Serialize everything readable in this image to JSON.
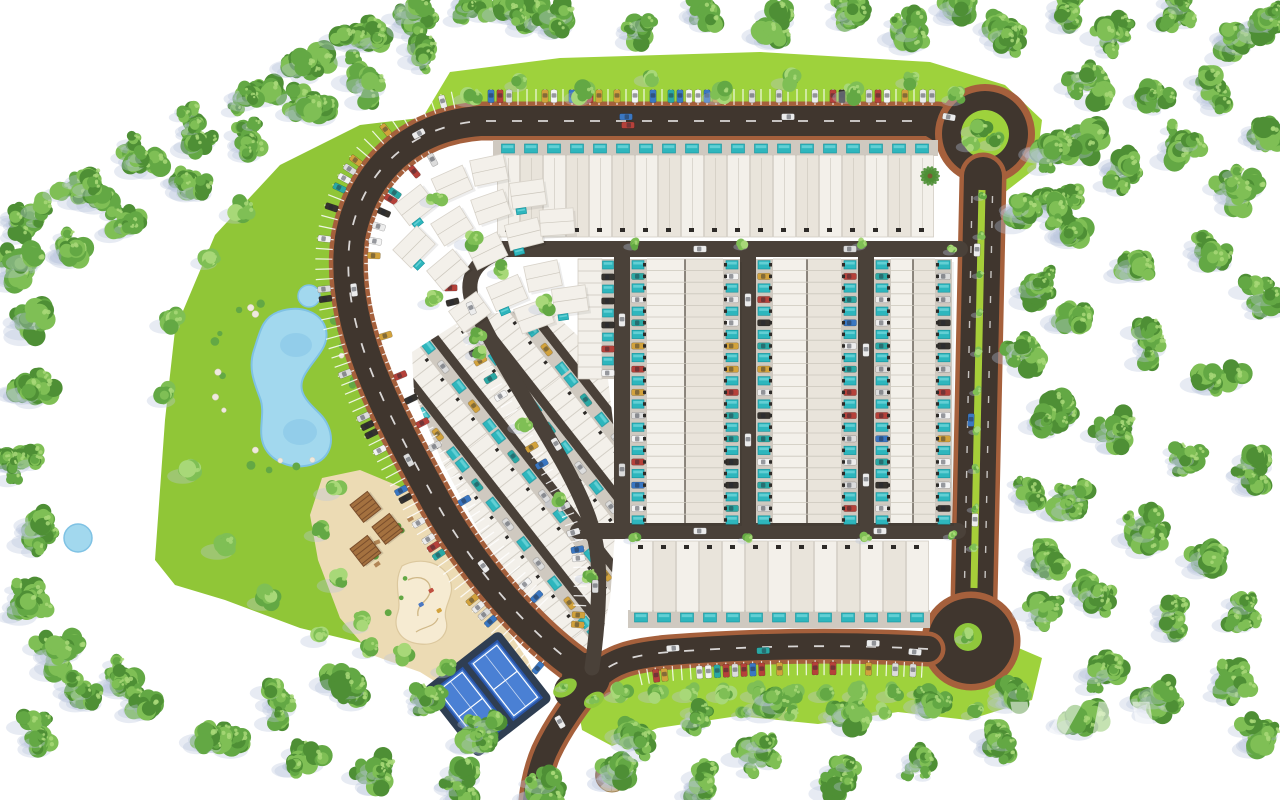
{
  "watermark": {
    "text": "VIV",
    "subtext": "E"
  },
  "scene": {
    "description": "Aerial top-down 3D masterplan rendering of a gated residential community: rows of white flat-roofed townhouses each with a private turquoise pool, a looping ring road with angled parking, a tree-lined boulevard with green median, two roundabouts, a landscaped park with a lake, a sand plaza with playground and pergolas, two blue padel courts, all surrounded by a dense green tree belt on white"
  },
  "features": [
    "perimeter-forest",
    "landscaped-park",
    "lake",
    "small-pond",
    "row-houses-with-private-pools",
    "villa-cluster",
    "ring-road",
    "large-roundabout",
    "cul-de-sac-roundabout",
    "boulevard-green-median",
    "angled-surface-parking",
    "parked-cars",
    "sand-plaza",
    "playground",
    "pergolas",
    "padel-courts",
    "dome-kiosk"
  ],
  "palette": {
    "background": "#ffffff",
    "road_asphalt": "#40362e",
    "road_inner": "#4a4139",
    "sidewalk_brick": "#a5603c",
    "grass_bright": "#9ed23c",
    "grass_park": "#90c637",
    "median_lime": "#a6ce39",
    "island_green": "#8fc73c",
    "forest_dark": "#4e8f35",
    "forest_mid": "#63a844",
    "forest_light": "#7fbf55",
    "tree_highlight": "#a8d878",
    "shadow_blue": "#b9c6de",
    "house_roof": "#f3f0ea",
    "house_shade": "#e9e4db",
    "house_seam": "#6b635a",
    "house_line": "#ccc7bd",
    "apron_gray": "#cfc9c0",
    "pool_teal": "#2eb6bd",
    "pool_light": "#6fd6da",
    "lake_blue": "#a2d8ee",
    "lake_deep": "#7fc2e4",
    "sand": "#ecdbb4",
    "sand_light": "#f6ebd2",
    "pergola_brown": "#a4713f",
    "court_blue": "#4a80d4",
    "court_deck": "#2f3e52",
    "dome_tan": "#cdb794",
    "dome_brown": "#7a4a2e",
    "car_colors": [
      "#ececec",
      "#dcdcdc",
      "#b5413a",
      "#3a77c2",
      "#2aa8a4",
      "#d2a23c",
      "#35322e",
      "#f4f4f4"
    ]
  }
}
